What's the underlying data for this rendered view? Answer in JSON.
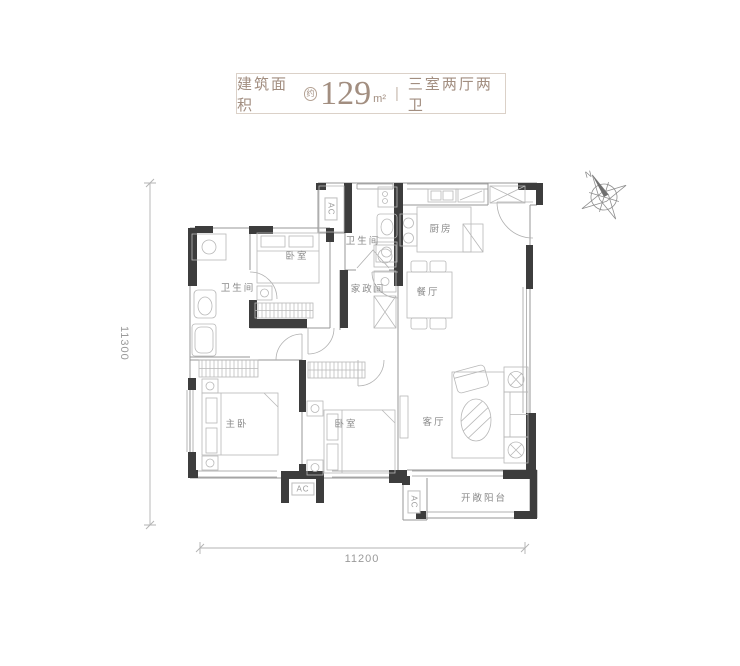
{
  "title": {
    "label": "建筑面积",
    "approx": "约",
    "area_value": "129",
    "area_unit": "m²",
    "divider": "|",
    "layout": "三室两厅两卫"
  },
  "rooms": {
    "bedroom1": "卧室",
    "bath1": "卫生间",
    "bath2": "卫生间",
    "laundry": "家政间",
    "kitchen": "厨房",
    "dining": "餐厅",
    "master": "主卧",
    "bedroom2": "卧室",
    "living": "客厅",
    "balcony": "开敞阳台"
  },
  "ac": {
    "label": "AC"
  },
  "dimensions": {
    "left": "11300",
    "bottom": "11200"
  },
  "compass": {
    "north": "N"
  },
  "colors": {
    "accent": "#a28e80",
    "wall": "#3d3d3d",
    "line": "#9b9b9b",
    "text": "#8a8a8a"
  }
}
